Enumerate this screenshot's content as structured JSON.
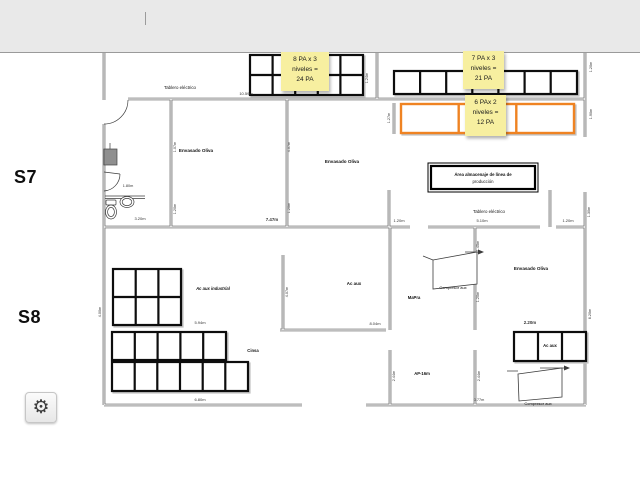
{
  "window": {
    "top_bar_color": "#e9e9e9"
  },
  "sections": {
    "s7": "S7",
    "s8": "S8"
  },
  "notes": [
    {
      "line1": "8 PA x 3",
      "line2": "niveles =",
      "line3": "24 PA"
    },
    {
      "line1": "7 PA x 3",
      "line2": "niveles =",
      "line3": "21 PA"
    },
    {
      "line1": "6 PAx 2",
      "line2": "niveles =",
      "line3": "12 PA"
    }
  ],
  "colors": {
    "note_bg": "#f7efa0",
    "orange_rack": "#ef8322",
    "rack_border": "#0d0d0d"
  },
  "plan": {
    "labels": {
      "tablero_top": "Tablero eléctrico",
      "tablero_mid": "Tablero eléctrico",
      "envasado_1": "Envasado Oliva",
      "envasado_2": "Envasado Oliva",
      "envasado_3": "Envasado Oliva",
      "area_line1": "Área almacenaje de línea de",
      "area_line2": "producción",
      "ac_aux_room": "Ac aux",
      "mapra": "MaPra",
      "compresor_1": "Compresor aux",
      "ac_aux_industrial": "Ac aux industrial",
      "cinsa": "Cinsa",
      "ap16": "AP-16m",
      "ac_aux_rack": "Ac aux",
      "compresor_2": "Compresor aux"
    },
    "dims": {
      "d1059": "10.59m",
      "d120a": "1.20m",
      "d510": "5.10m",
      "d120b": "1.20m",
      "d747": "7.47m",
      "d320": "3.20m",
      "d180": "1.80m",
      "d594": "5.94m",
      "d804": "8.04m",
      "d220": "2.20m",
      "d680": "6.80m",
      "d077": "0.77m",
      "r107": "1.07m",
      "r120a": "1.20m",
      "r407a": "4.07m",
      "r120b": "1.20m",
      "r124": "1.24m",
      "r127": "1.27m",
      "r120c": "1.20m",
      "r190": "1.90m",
      "r130": "1.30m",
      "r145": "1.45m",
      "r120d": "1.20m",
      "r620": "6.20m",
      "r244a": "2.44m",
      "r244b": "2.44m",
      "r400": "4.00m",
      "r407b": "4.07m"
    }
  },
  "toolbar": {
    "gear_icon": "⚙"
  }
}
